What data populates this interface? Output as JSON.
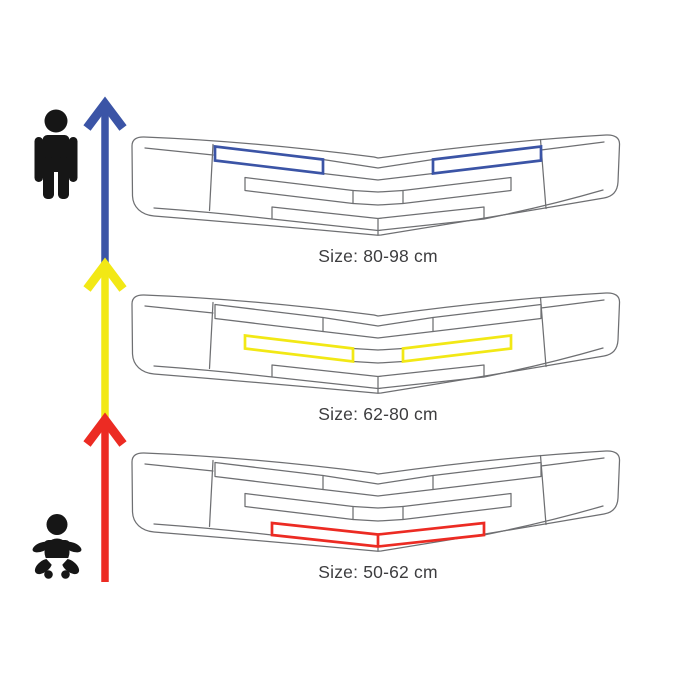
{
  "figure": {
    "background_color": "#ffffff",
    "outline_color": "#6e6f72",
    "text_color": "#3d3d3f",
    "icon_color": "#161616",
    "sizes": [
      {
        "label": "Size: 80-98 cm",
        "highlight_color": "#3b54a6",
        "highlight_row": "top"
      },
      {
        "label": "Size: 62-80 cm",
        "highlight_color": "#f2e815",
        "highlight_row": "middle"
      },
      {
        "label": "Size: 50-62 cm",
        "highlight_color": "#ec2b23",
        "highlight_row": "bottom-center"
      }
    ],
    "arrows": [
      {
        "name": "growth-arrow-blue",
        "color": "#3b54a6"
      },
      {
        "name": "growth-arrow-yellow",
        "color": "#f2e815"
      },
      {
        "name": "growth-arrow-red",
        "color": "#ec2b23"
      }
    ],
    "icons": [
      {
        "name": "person-icon"
      },
      {
        "name": "baby-icon"
      }
    ]
  }
}
